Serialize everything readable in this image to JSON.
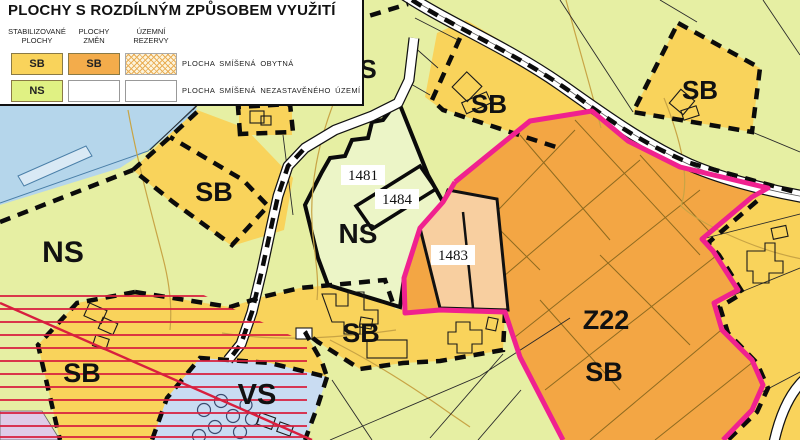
{
  "legend": {
    "title": "PLOCHY S ROZDÍLNÝM ZPŮSOBEM VYUŽITÍ",
    "columns": [
      {
        "line1": "STABILIZOVANÉ",
        "line2": "PLOCHY"
      },
      {
        "line1": "PLOCHY",
        "line2": "ZMĚN"
      },
      {
        "line1": "ÚZEMNÍ",
        "line2": "REZERVY"
      }
    ],
    "rows": [
      {
        "stab": "SB",
        "change": "SB",
        "desc": "PLOCHA SMÍŠENÁ OBYTNÁ"
      },
      {
        "stab": "NS",
        "change": "",
        "desc": "PLOCHA SMÍŠENÁ NEZASTAVĚNÉHO ÚZEMÍ"
      }
    ]
  },
  "map": {
    "labels": {
      "sb_left": "SB",
      "sb_top_mid": "SB",
      "sb_top_right": "SB",
      "sb_bottom_left": "SB",
      "sb_bottom_mid": "SB",
      "sb_right": "SB",
      "ns_left": "NS",
      "ns_center": "NS",
      "ns_partial": "S",
      "vs": "VS",
      "z22": "Z22",
      "parcel_1481": "1481",
      "parcel_1484": "1484",
      "parcel_1483": "1483"
    },
    "colors": {
      "sb_yellow": "#F9D35B",
      "sb_orange": "#F3AC4B",
      "z22_orange": "#F3A644",
      "ns_green": "#E6EFA3",
      "parcel_green": "#ECF5C7",
      "reserve_peach": "#F8CFA0",
      "water_blue": "#B5D6EB",
      "vs_blue": "#C9DCF2",
      "lavender": "#DFCBE8",
      "boundary_pink": "#F0218F",
      "z22_label": "#F000A5",
      "hatch_red": "#D81F3E",
      "contour_tan": "#C8A445"
    }
  }
}
